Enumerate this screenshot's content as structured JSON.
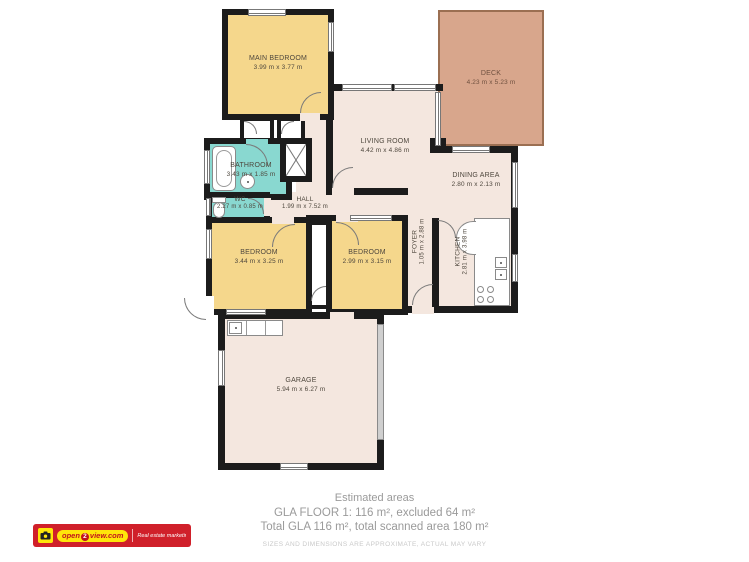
{
  "rooms": {
    "main_bedroom": {
      "name": "MAIN BEDROOM",
      "dims": "3.99 m x 3.77 m"
    },
    "deck": {
      "name": "DECK",
      "dims": "4.23 m x 5.23 m"
    },
    "living_room": {
      "name": "LIVING ROOM",
      "dims": "4.42 m x 4.86 m"
    },
    "dining_area": {
      "name": "DINING AREA",
      "dims": "2.80 m x 2.13 m"
    },
    "bathroom": {
      "name": "BATHROOM",
      "dims": "3.43 m x 1.85 m"
    },
    "wc": {
      "name": "WC",
      "dims": "2.27 m x 0.85 m"
    },
    "hall": {
      "name": "HALL",
      "dims": "1.99 m x 7.52 m"
    },
    "bedroom_left": {
      "name": "BEDROOM",
      "dims": "3.44 m x 3.25 m"
    },
    "bedroom_right": {
      "name": "BEDROOM",
      "dims": "2.99 m x 3.15 m"
    },
    "foyer": {
      "name": "FOYER",
      "dims": "1.05 m x 2.88 m"
    },
    "kitchen": {
      "name": "KITCHEN",
      "dims": "2.81 m x 3.98 m"
    },
    "garage": {
      "name": "GARAGE",
      "dims": "5.94 m x 6.27 m"
    }
  },
  "summary": {
    "title": "Estimated areas",
    "line1": "GLA FLOOR 1: 116 m², excluded 64 m²",
    "line2": "Total GLA 116 m², total scanned area 180 m²",
    "disclaimer": "SIZES AND DIMENSIONS ARE APPROXIMATE, ACTUAL MAY VARY"
  },
  "branding": {
    "logo_pre": "open",
    "logo_num": "2",
    "logo_post": "view.com",
    "tagline": "Real estate marketing solutions"
  },
  "colors": {
    "wall": "#1c1c1c",
    "bedroom": "#f5d78c",
    "wet": "#89d8d0",
    "floor": "#f4e7df",
    "deck": "#d8a68c",
    "deck_border": "#9b6f52",
    "label": "#4e473d",
    "summary_text": "#9a9a9a",
    "disclaimer": "#c9c9c9",
    "logo_red": "#d0202a",
    "logo_yellow": "#ffe60a"
  }
}
